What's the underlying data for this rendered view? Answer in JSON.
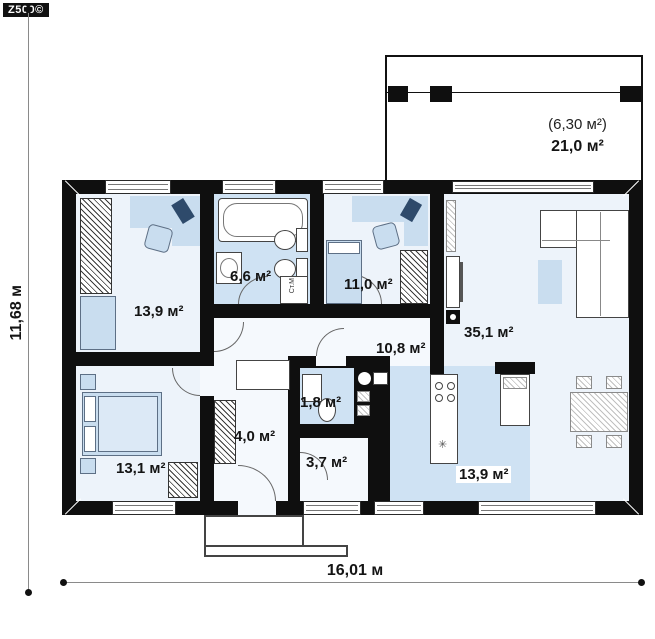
{
  "logo": {
    "text": "Z500©"
  },
  "dimensions": {
    "height_label": "11,68 м",
    "width_label": "16,01 м"
  },
  "terrace": {
    "secondary_area": "(6,30 м²)",
    "area": "21,0 м²"
  },
  "rooms": {
    "bedroom_top_left": "13,9 м²",
    "bathroom": "6,6 м²",
    "bedroom_top_mid": "11,0 м²",
    "living_room": "35,1 м²",
    "hall": "10,8 м²",
    "wc": "1,8 м²",
    "entry": "4,0 м²",
    "pantry": "3,7 м²",
    "bedroom_bottom_left": "13,1 м²",
    "kitchen": "13,9 м²"
  },
  "labels": {
    "washing_machine": "Ст.М",
    "sink_symbol": "✳"
  },
  "colors": {
    "wall": "#0f0f0f",
    "floor_light": "#edf3fa",
    "floor_wet": "#cfe2f3",
    "furniture_blue": "#c9ddef"
  }
}
